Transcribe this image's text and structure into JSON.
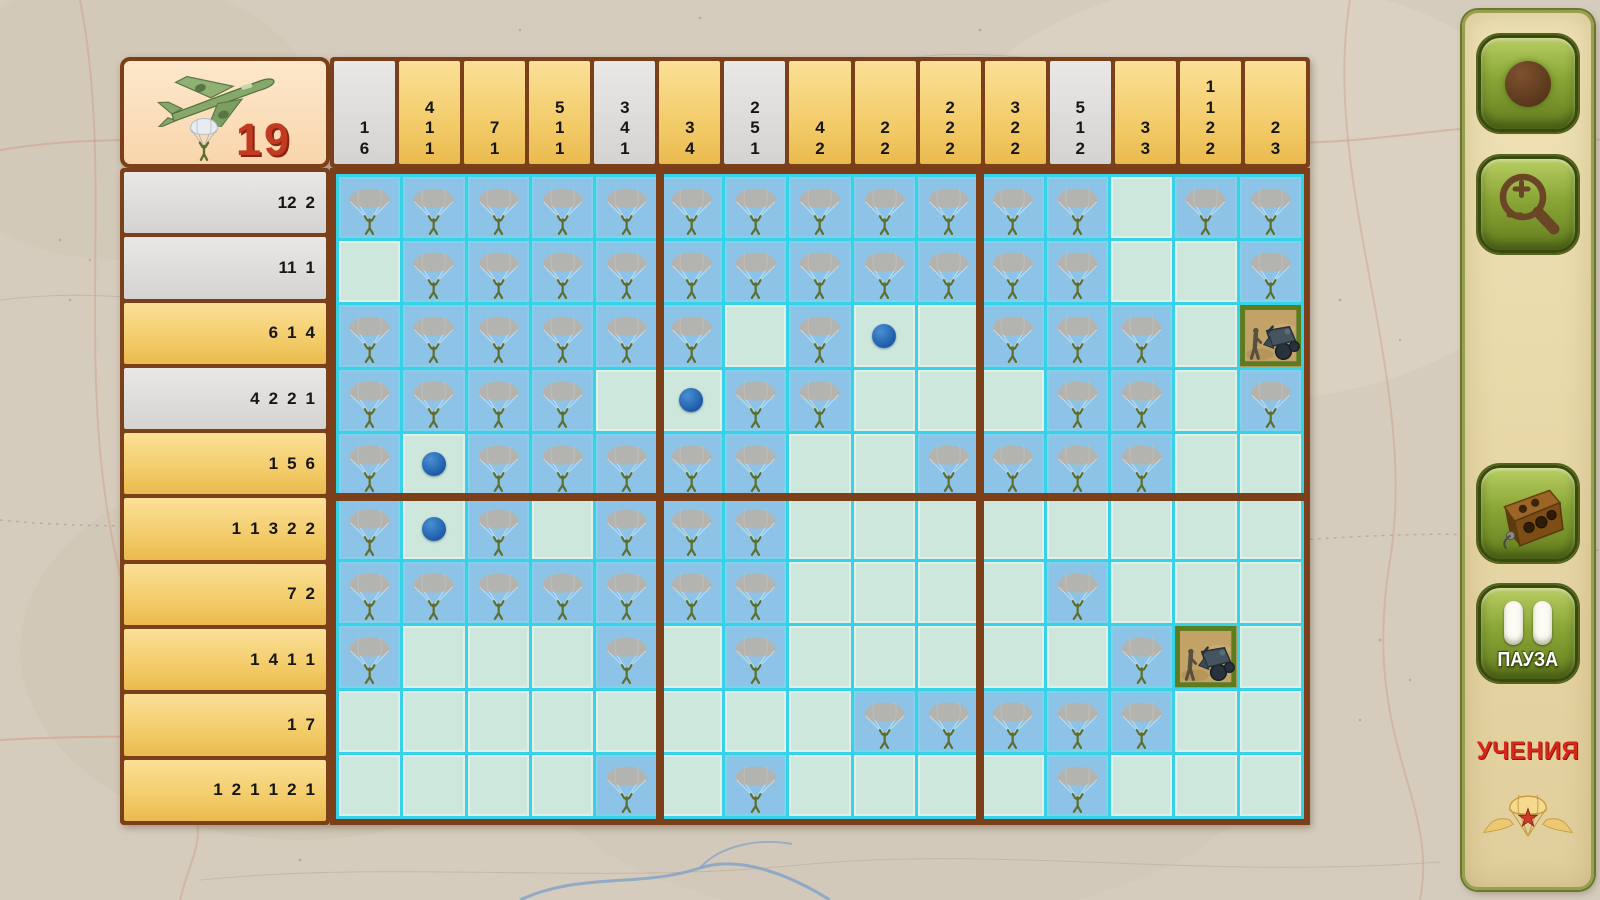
{
  "header": {
    "remaining_count": "19",
    "plane_icon": "bomber-plane-icon",
    "paratrooper_icon": "paratrooper-counter-icon"
  },
  "board": {
    "columns": [
      {
        "clues": [
          "1",
          "6"
        ],
        "completed": true
      },
      {
        "clues": [
          "4",
          "1",
          "1"
        ],
        "completed": false
      },
      {
        "clues": [
          "7",
          "1"
        ],
        "completed": false
      },
      {
        "clues": [
          "5",
          "1",
          "1"
        ],
        "completed": false
      },
      {
        "clues": [
          "3",
          "4",
          "1"
        ],
        "completed": true
      },
      {
        "clues": [
          "3",
          "4"
        ],
        "completed": false
      },
      {
        "clues": [
          "2",
          "5",
          "1"
        ],
        "completed": true
      },
      {
        "clues": [
          "4",
          "2"
        ],
        "completed": false
      },
      {
        "clues": [
          "2",
          "2"
        ],
        "completed": false
      },
      {
        "clues": [
          "2",
          "2",
          "2"
        ],
        "completed": false
      },
      {
        "clues": [
          "3",
          "2",
          "2"
        ],
        "completed": false
      },
      {
        "clues": [
          "5",
          "1",
          "2"
        ],
        "completed": true
      },
      {
        "clues": [
          "3",
          "3"
        ],
        "completed": false
      },
      {
        "clues": [
          "1",
          "1",
          "2",
          "2"
        ],
        "completed": false
      },
      {
        "clues": [
          "2",
          "3"
        ],
        "completed": false
      }
    ],
    "rows": [
      {
        "clues": [
          "12",
          "2"
        ],
        "completed": true
      },
      {
        "clues": [
          "11",
          "1"
        ],
        "completed": true
      },
      {
        "clues": [
          "6",
          "1",
          "4"
        ],
        "completed": false
      },
      {
        "clues": [
          "4",
          "2",
          "2",
          "1"
        ],
        "completed": true
      },
      {
        "clues": [
          "1",
          "5",
          "6"
        ],
        "completed": false
      },
      {
        "clues": [
          "1",
          "1",
          "3",
          "2",
          "2"
        ],
        "completed": false
      },
      {
        "clues": [
          "7",
          "2"
        ],
        "completed": false
      },
      {
        "clues": [
          "1",
          "4",
          "1",
          "1"
        ],
        "completed": false
      },
      {
        "clues": [
          "1",
          "7"
        ],
        "completed": false
      },
      {
        "clues": [
          "1",
          "2",
          "1",
          "1",
          "2",
          "1"
        ],
        "completed": false
      }
    ],
    "cell_legend": {
      "P": "paratrooper-filled",
      ".": "cleared-empty",
      "D": "blue-dot-mark",
      "M": "vehicle-unit-tile"
    },
    "cells": [
      "PPPPPPPPPPPP.PP",
      ".PPPPPPPPPPP..P",
      "PPPPPP.PD.PPP.M",
      "PPPP.DPP...PP.P",
      "PDPPPPP..PPPP..",
      "PDP.PPP........",
      "PPPPPPP....P...",
      "P...P.P.....PM.",
      "........PPPPP..",
      "....P.P....P..."
    ]
  },
  "sidebar": {
    "buttons": [
      {
        "name": "mark-tool-button",
        "icon": "brown-dot-marker-icon"
      },
      {
        "name": "zoom-button",
        "icon": "magnifier-plus-minus-icon"
      },
      {
        "name": "radio-button",
        "icon": "field-radio-icon"
      },
      {
        "name": "pause-button",
        "icon": "pause-bars-icon",
        "label": "ПАУЗА"
      }
    ],
    "mode_label": "УЧЕНИЯ",
    "emblem_icon": "airborne-parachute-star-badge"
  },
  "colors": {
    "frame_brown": "#7b4019",
    "grid_cyan": "#38d2e8",
    "cell_blue": "#8dc3e6",
    "cell_empty": "#cde7dc",
    "clue_yellow": "#f2ca66",
    "clue_gray": "#d9d8d6",
    "dot_blue": "#1d5da8",
    "accent_red": "#d5281b",
    "button_green": "#8aa636",
    "panel_tan": "#e6d6a5"
  }
}
